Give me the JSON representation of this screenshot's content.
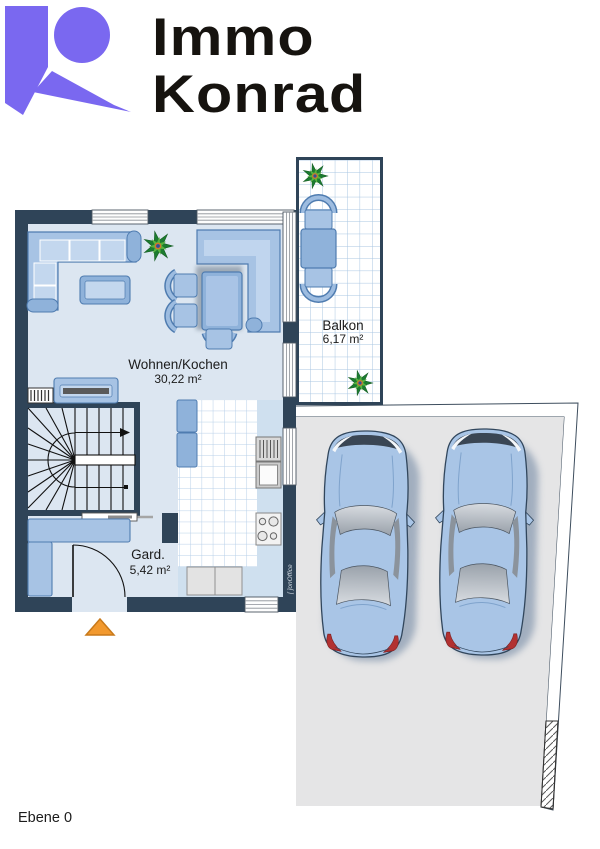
{
  "brand": {
    "line1": "Immo",
    "line2": "Konrad"
  },
  "floor_plan": {
    "rooms": [
      {
        "name": "Wohnen/Kochen",
        "area": "30,22 m²"
      },
      {
        "name": "Balkon",
        "area": "6,17 m²"
      },
      {
        "name": "Gard.",
        "area": "5,42 m²"
      }
    ],
    "level_label": "Ebene 0",
    "watermark": "[ ]onOffice"
  },
  "colors": {
    "brand_purple": "#7a68f0",
    "wall": "#2f4458",
    "floor": "#dce6f1",
    "furniture": "#a7c3e4",
    "parking_gray": "#e5e5e6",
    "entrance_marker": "#f2992e",
    "car_body": "#a9c5e6"
  }
}
